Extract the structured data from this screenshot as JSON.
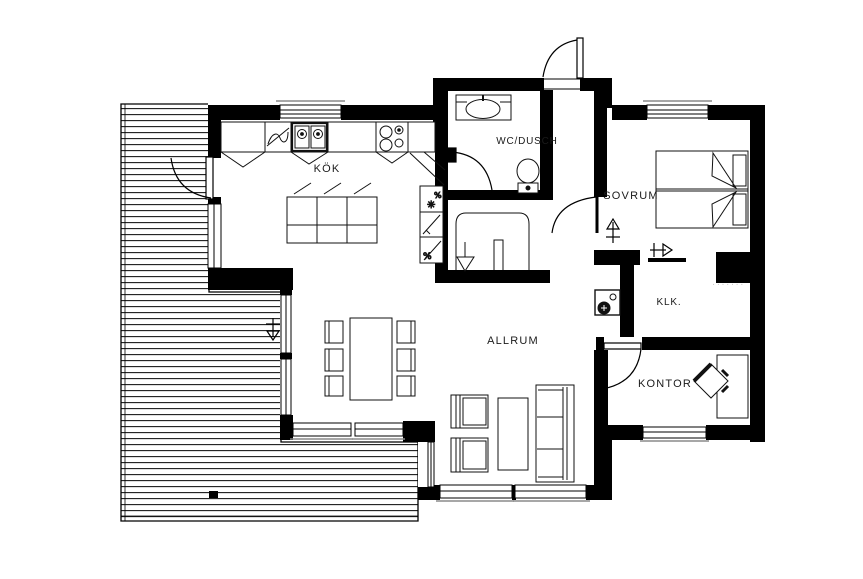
{
  "plan": {
    "type": "floor-plan",
    "background": "#ffffff",
    "wall_color": "#000000",
    "line_color": "#111111",
    "sill_color": "#8a8a8a",
    "stamp_color": "#c4c4c4",
    "rooms": {
      "kok": {
        "label": "KÖK"
      },
      "wc": {
        "label": "WC/DUSCH"
      },
      "sovrum": {
        "label": "SOVRUM"
      },
      "klk": {
        "label": "KLK."
      },
      "allrum": {
        "label": "ALLRUM"
      },
      "kontor": {
        "label": "KONTOR"
      }
    },
    "symbols": {
      "laundry_top": "✳",
      "laundry_pct1": "%",
      "laundry_pct2": "%",
      "stamp": "·······"
    }
  }
}
